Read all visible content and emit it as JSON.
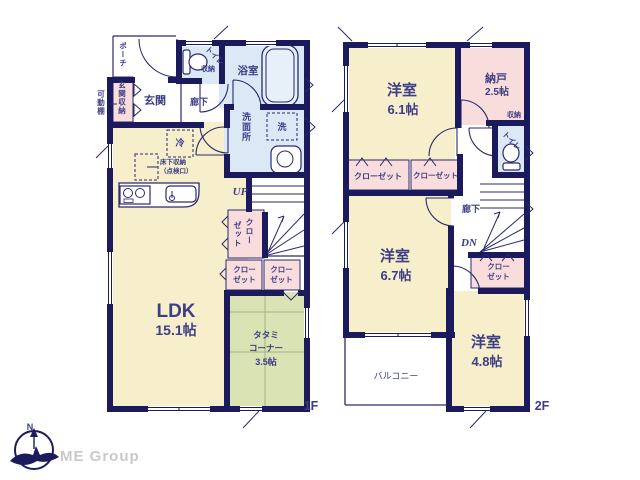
{
  "branding": {
    "company": "ME Group",
    "compass_n": "N"
  },
  "colors": {
    "wall": "#1b1a5c",
    "text": "#3e3e86",
    "room_cream": "#f7eecb",
    "wet_blue": "#dbe8f6",
    "closet_pink": "#f9dcdc",
    "tatami_green": "#d9e3b4",
    "logo_gray": "#c9c9c9"
  },
  "floor1": {
    "floor_label": "1F",
    "porch": "ポーチ",
    "movable_shelf": "可動棚",
    "entrance_storage": "玄関収納",
    "entrance": "玄関",
    "hallway": "廊下",
    "toilet": "トイレ",
    "toilet_storage": "収納",
    "bathroom": "浴室",
    "washroom": "洗面所",
    "washer": "洗",
    "fridge": "冷",
    "underfloor_l1": "床下収納",
    "underfloor_l2": "（点検口）",
    "up": "UP",
    "closet": "クローゼット",
    "closet_l1": "クロー",
    "closet_l2": "ゼット",
    "ldk_name": "LDK",
    "ldk_size": "15.1帖",
    "tatami_l1": "タタミ",
    "tatami_l2": "コーナー",
    "tatami_l3": "3.5帖"
  },
  "floor2": {
    "floor_label": "2F",
    "room1_name": "洋室",
    "room1_size": "6.1帖",
    "storeroom": "納戸",
    "storeroom_size": "2.5帖",
    "storage": "収納",
    "toilet": "トイレ",
    "hallway": "廊下",
    "dn": "DN",
    "closet": "クローゼット",
    "closet_l1": "クロー",
    "closet_l2": "ゼット",
    "room2_name": "洋室",
    "room2_size": "6.7帖",
    "room3_name": "洋室",
    "room3_size": "4.8帖",
    "balcony": "バルコニー"
  }
}
